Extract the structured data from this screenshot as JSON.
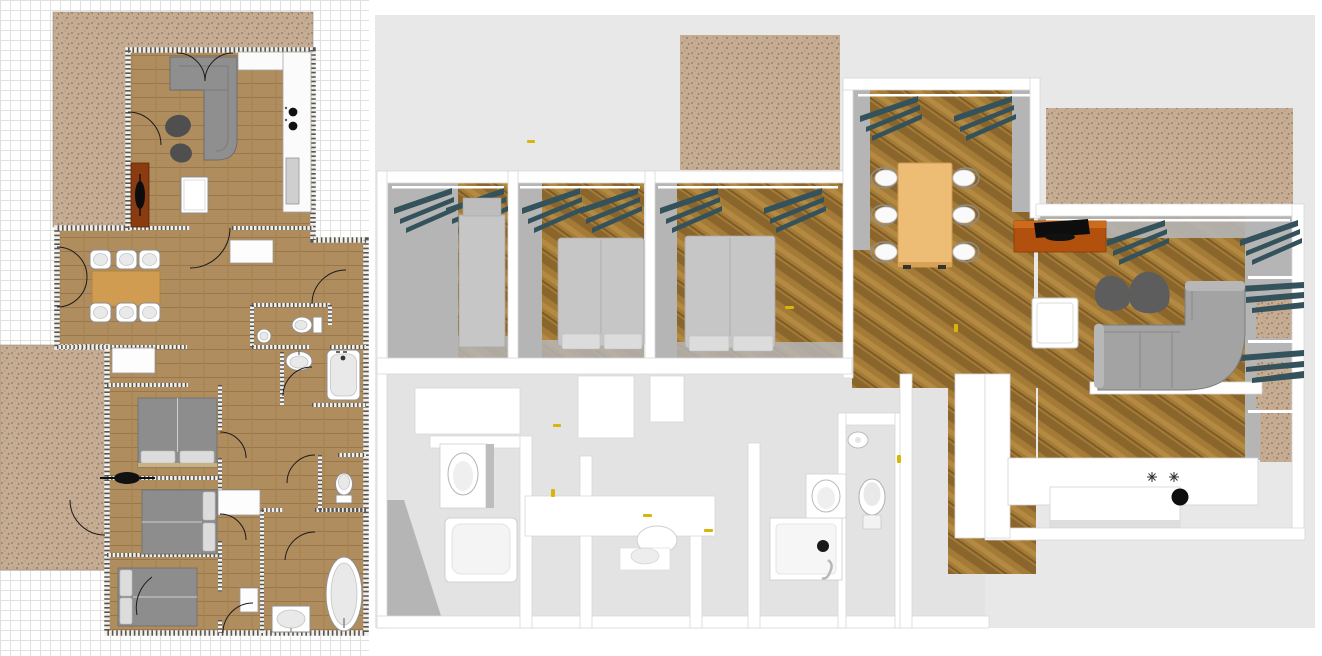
{
  "app": {
    "type": "home-design-floorplan-tool",
    "left_pane": "2D plan view",
    "right_pane": "3D aerial view",
    "visible_text": ""
  },
  "colors": {
    "bg_page": "#ffffff",
    "grid_minor": "#e0e0e0",
    "grid_major": "#cdcdcd",
    "bg_3d": "#e8e8e8",
    "wood2d_base": "#b08d5e",
    "wood2d_line": "#99774b",
    "wood3d_base": "#a37a36",
    "wood3d_dark": "#8a652c",
    "terrace_base": "#c5ac93",
    "terrace_dot": "#8b7862",
    "wall2d_stroke": "#2e2e2e",
    "wall3d_white": "#ffffff",
    "wallface_gray": "#b5b5b5",
    "floor_gray": "#e3e3e3",
    "sofa2d": "#8f8f8f",
    "sofa3d": "#a3a3a3",
    "armchair": "#4f4f4f",
    "beanbag": "#5d5d5d",
    "tv_cab2d": "#8a3b10",
    "tv_cab3d": "#b2500e",
    "tv_black": "#101010",
    "table2d": "#cf9c51",
    "table3d": "#eebd75",
    "bed2d": "#8d8d8d",
    "bed3d": "#c6c6c6",
    "pillow": "#e8e8e8",
    "headboard_tan": "#c9b183",
    "curtain": "#33525b",
    "yellow": "#d9b40a",
    "fixture_edge": "#8f8f8f"
  },
  "plan2d": {
    "label": "2D floor plan with grid",
    "rooms": [
      "living-room",
      "kitchen",
      "dining-room",
      "hallway",
      "bedroom-1",
      "bedroom-2",
      "bedroom-3",
      "wc",
      "bathroom",
      "wc-2",
      "bathroom-2",
      "terrace-north",
      "terrace-west"
    ],
    "furniture": [
      "corner-sofa",
      "armchair-1",
      "armchair-2",
      "tv-cabinet",
      "tv",
      "coffee-table",
      "kitchen-counter",
      "cooktop-2-burners",
      "kitchen-sink",
      "dining-table",
      "dining-chairs-x6",
      "closet-1",
      "closet-2",
      "closet-3",
      "closet-4",
      "double-bed-1",
      "double-bed-2",
      "double-bed-3",
      "ceiling-fan",
      "toilet",
      "washbasin-small",
      "washbasin",
      "bathtub",
      "toilet-2",
      "oval-bathtub",
      "washbasin-2"
    ]
  },
  "view3d": {
    "label": "3D aerial cutaway view",
    "camera": "aerial",
    "rooms": [
      "bedroom-1",
      "bedroom-2",
      "bedroom-3",
      "dining-room",
      "living-room",
      "kitchen",
      "bathroom-1",
      "bathroom-2",
      "wc",
      "terrace-a",
      "terrace-b"
    ],
    "furniture": [
      "wardrobe",
      "double-bed-2",
      "double-bed-3",
      "curtains-teal",
      "dining-table",
      "dining-chairs-x6",
      "tv-cabinet",
      "tv",
      "beanbag-x2",
      "coffee-table",
      "corner-sofa",
      "kitchen-counter",
      "cooktop-2-burners",
      "kitchen-sink-black",
      "vanity-sink-1",
      "bathtub",
      "shower-tray",
      "toilet",
      "vanity-sink-2",
      "washbasin-small"
    ]
  }
}
